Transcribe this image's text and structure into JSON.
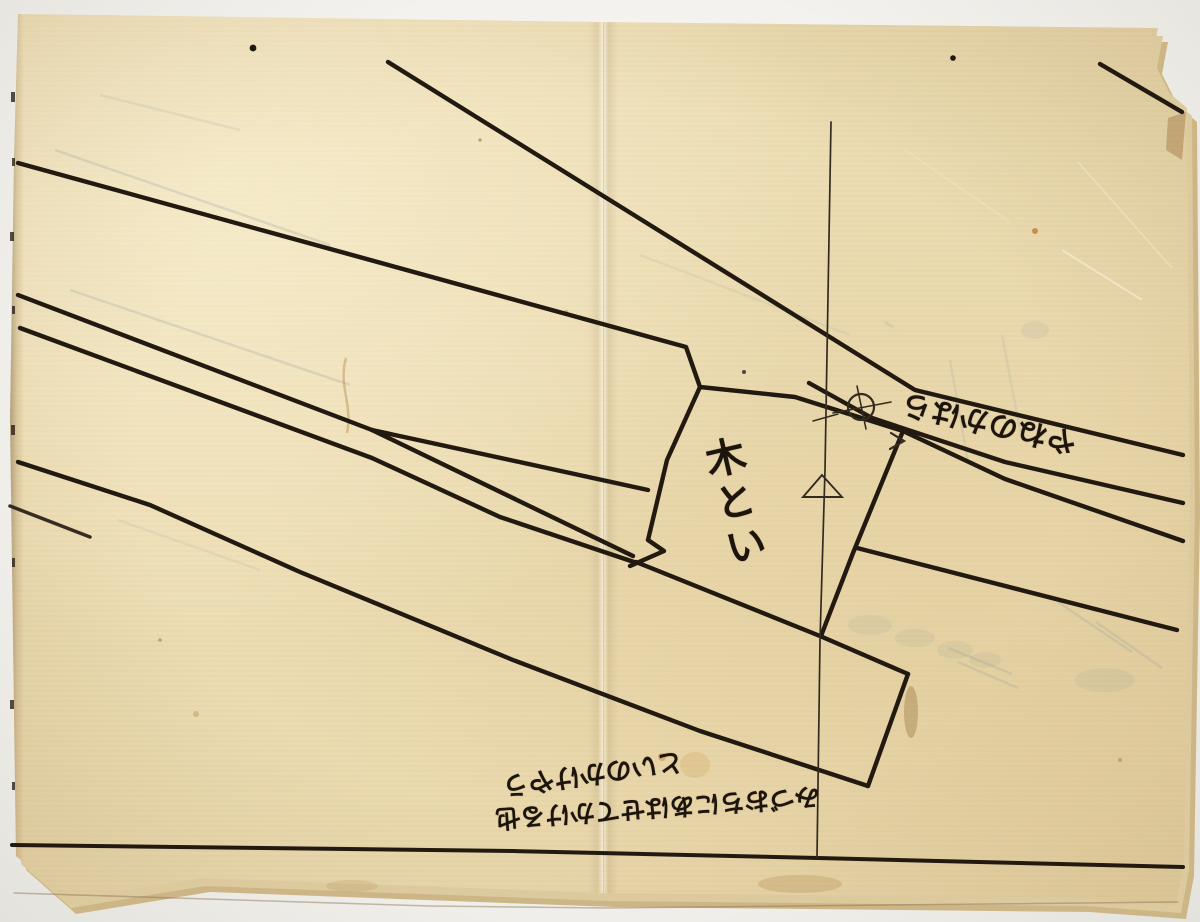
{
  "labels": {
    "gutter": "木とい",
    "roof_edge": "やねのかはら"
  },
  "annotations": {
    "line1": "といのかけやう",
    "line2": "みづおちにあはせてかける也"
  },
  "symbols": {
    "circle_cross": "circle-cross-mark",
    "triangle": "triangle-mark"
  },
  "colors": {
    "background": "#f3f2ee",
    "paper": "#ecdcb2",
    "paper_edge": "#d7c090",
    "ink": "#221a11",
    "pencil_ghost": "#9ba4a2",
    "stain": "#b98a50"
  }
}
